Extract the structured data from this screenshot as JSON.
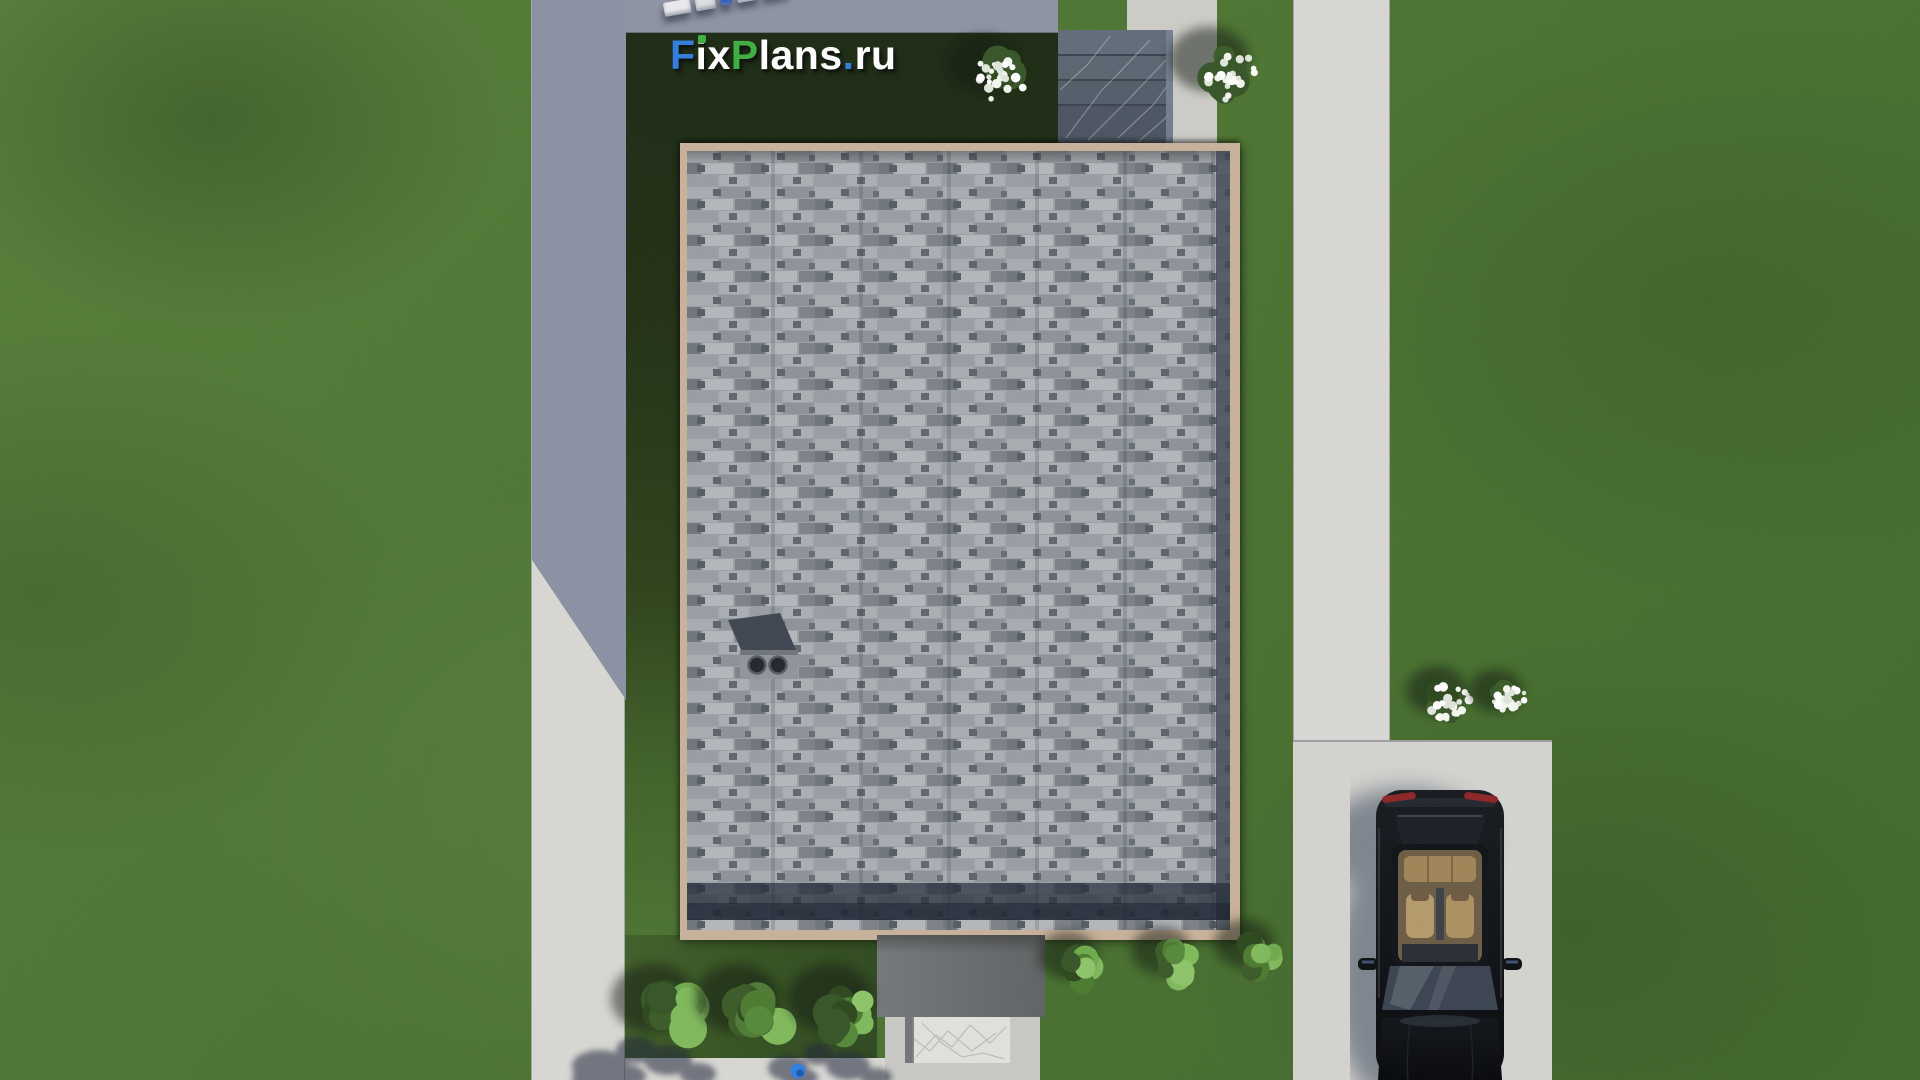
{
  "scene": {
    "description": "Top-down 3D site render of a house: gray shingled roof, lawns, concrete paths, driveway with black car, bushes, FixPlans.ru watermark",
    "watermark": {
      "text": "FixPlans.ru",
      "segments": [
        {
          "t": "F",
          "c": "#2f7ce0"
        },
        {
          "t": "ix",
          "c": "#ffffff"
        },
        {
          "t": "P",
          "c": "#3cae3e"
        },
        {
          "t": "lans",
          "c": "#ffffff"
        },
        {
          "t": ".",
          "c": "#2f7ce0"
        },
        {
          "t": "ru",
          "c": "#ffffff"
        }
      ]
    },
    "palette": {
      "grass": "#4b7330",
      "grassLight": "#567d38",
      "grassDeep": "#40682a",
      "lawnDark": "#1b2912",
      "road": "#8d93a2",
      "pathShadow": "#8991a3",
      "pathLight": "#d8d7d3",
      "walkway": "#cdccc7",
      "driveway": "#d4d3cf",
      "fascia": "#c9b199",
      "steps": "#57606c",
      "stepsDark": "#4a5360",
      "stepsVein": "#c7d2da",
      "porch": "#6c6f71",
      "apron": "#c9c8c4",
      "slab": "#e2e1dc",
      "logoGreen": "#3cae3e",
      "carBody": "#0c0e12",
      "carGlass": "#23282f",
      "carWindshield": "#39424f",
      "carInteriorFloor": "#6b5b43",
      "carSeat": "#b39a6a",
      "carBench": "#a08457",
      "taillight": "#8e2424",
      "carShadow": "#2c3750",
      "truckBlue": "#2a57c8",
      "blueObject": "#2e7de4",
      "shingleLight": "#b3b7bb",
      "shingleMid": "#9ba0a6",
      "shingleDark": "#70757c",
      "eave": "#1f2836"
    },
    "objects": {
      "truck": {
        "x": 664,
        "y": 2,
        "angle": -10,
        "segments": [
          {
            "w": 27,
            "h": 14,
            "c": "#e9eaec"
          },
          {
            "w": 20,
            "h": 13,
            "c": "#dde0e3"
          },
          {
            "w": 12,
            "h": 12,
            "c": "#2a57c8"
          },
          {
            "w": 22,
            "h": 12,
            "c": "#e4e6e8"
          },
          {
            "w": 26,
            "h": 12,
            "c": "#eef0f1"
          }
        ]
      },
      "bushes": [
        {
          "type": "white",
          "x": 1000,
          "y": 78,
          "r": 34
        },
        {
          "type": "white",
          "x": 1228,
          "y": 75,
          "r": 38
        },
        {
          "type": "white",
          "x": 1450,
          "y": 702,
          "r": 28
        },
        {
          "type": "white",
          "x": 1508,
          "y": 701,
          "r": 25
        },
        {
          "type": "green",
          "x": 673,
          "y": 1015,
          "r": 40
        },
        {
          "type": "green",
          "x": 757,
          "y": 1015,
          "r": 40
        },
        {
          "type": "green",
          "x": 850,
          "y": 1015,
          "r": 40
        },
        {
          "type": "green",
          "x": 1082,
          "y": 967,
          "r": 28
        },
        {
          "type": "green",
          "x": 1175,
          "y": 962,
          "r": 28
        },
        {
          "type": "green",
          "x": 1258,
          "y": 955,
          "r": 28
        }
      ],
      "treeShadows": [
        [
          [
            600,
            1066,
            28,
            16
          ],
          [
            636,
            1050,
            20,
            13
          ],
          [
            668,
            1060,
            24,
            15
          ],
          [
            698,
            1074,
            18,
            11
          ],
          [
            622,
            1076,
            24,
            12
          ],
          [
            590,
            1078,
            18,
            10
          ]
        ],
        [
          [
            788,
            1068,
            20,
            13
          ],
          [
            818,
            1054,
            15,
            11
          ],
          [
            848,
            1066,
            22,
            14
          ],
          [
            876,
            1077,
            16,
            9
          ],
          [
            800,
            1078,
            18,
            10
          ]
        ]
      ],
      "blueObject": {
        "x": 798,
        "y": 1071,
        "r": 7.5
      }
    }
  }
}
